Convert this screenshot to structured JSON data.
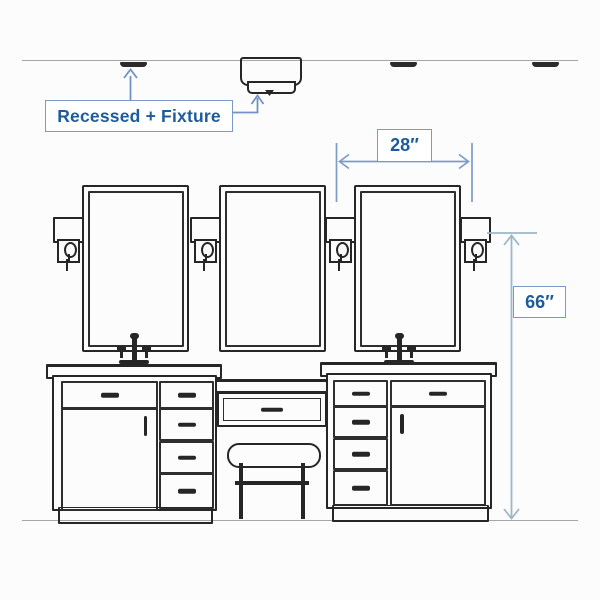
{
  "labels": {
    "recessed_fixture": "Recessed + Fixture",
    "sconce_spacing_dim": "28″",
    "sconce_height_dim": "66″"
  },
  "colors": {
    "label_text": "#1d5c9c",
    "label_box_border": "#7a99c6",
    "leader_and_dim_lines": "#7292c3",
    "height_dim_line": "#9db7ca",
    "drawing_ink": "#262626",
    "ceiling_floor_line": "#a6a6a6",
    "background": "#fcfcfc"
  },
  "diagram_meta": {
    "type": "bathroom-vanity-lighting-dimension-diagram",
    "mirror_count": 3,
    "sconce_count": 4,
    "recessed_light_count": 3
  }
}
